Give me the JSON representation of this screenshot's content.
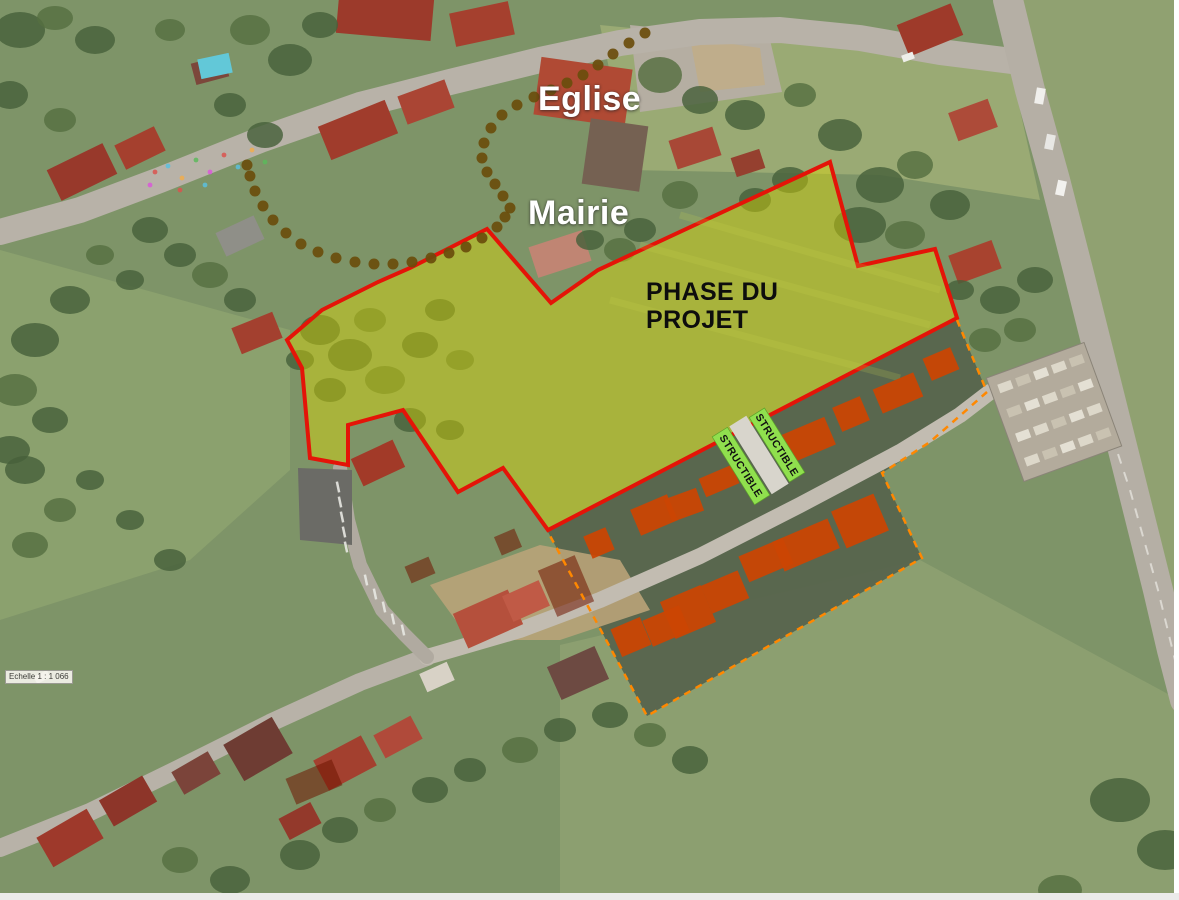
{
  "labels": {
    "eglise": "Eglise",
    "mairie": "Mairie",
    "phase_line1": "PHASE DU",
    "phase_line2": "PROJET",
    "band1": "STRUCTIBLE",
    "band2": "STRUCTIBLE",
    "scale": "Echelle 1 : 1 066"
  },
  "colors": {
    "project_outline": "#e41408",
    "project_fill": "rgba(226,222,0,0.42)",
    "footprint": "#cb4503",
    "demolition": "#6f1400",
    "parcel_dash": "#ff8800",
    "band_green": "#90e04e",
    "trail_dot": "#6a4d0c",
    "road_gray": "#b8b2a8",
    "tree_green": "#47603a",
    "dark_band": "#57644d"
  },
  "map": {
    "base": "#7e9468",
    "fields": [
      {
        "points": "600,25 1010,65 1040,200 880,175 630,170",
        "fill": "#9aaa74"
      },
      {
        "points": "1012,0 1179,0 1179,680",
        "fill": "#90a171"
      },
      {
        "points": "560,645 920,560 1179,700 1179,893 560,893",
        "fill": "#8c9f70"
      },
      {
        "points": "0,250 290,330 290,470 190,560 0,620",
        "fill": "#8ba16e"
      },
      {
        "points": "630,25 770,40 782,92 640,112",
        "fill": "#b5aea2"
      }
    ],
    "dark_band": {
      "points": "548,532 957,320 987,392 930,442 882,473 922,558 647,716",
      "fill": "#57644d"
    },
    "tan_patches": [
      {
        "points": "430,585 540,545 620,560 650,610 560,640 470,640",
        "fill": "#b9a379"
      },
      {
        "points": "690,38 760,48 765,85 700,92",
        "fill": "#c0ad88"
      }
    ],
    "roads": [
      {
        "pts": [
          [
            0,
            232
          ],
          [
            80,
            210
          ],
          [
            160,
            180
          ],
          [
            260,
            140
          ],
          [
            360,
            105
          ],
          [
            450,
            82
          ],
          [
            540,
            60
          ],
          [
            620,
            43
          ],
          [
            700,
            32
          ],
          [
            780,
            30
          ],
          [
            860,
            38
          ],
          [
            940,
            52
          ],
          [
            1020,
            62
          ]
        ],
        "w": 26,
        "c": "#b8b2a8"
      },
      {
        "pts": [
          [
            1008,
            0
          ],
          [
            1030,
            90
          ],
          [
            1055,
            180
          ],
          [
            1078,
            270
          ],
          [
            1098,
            350
          ],
          [
            1118,
            430
          ],
          [
            1138,
            510
          ],
          [
            1158,
            590
          ],
          [
            1172,
            650
          ],
          [
            1185,
            700
          ]
        ],
        "w": 30,
        "c": "#b5afa5"
      },
      {
        "pts": [
          [
            0,
            848
          ],
          [
            90,
            812
          ],
          [
            180,
            768
          ],
          [
            270,
            723
          ],
          [
            360,
            682
          ],
          [
            427,
            657
          ]
        ],
        "w": 18,
        "c": "#b8b2a8"
      },
      {
        "pts": [
          [
            427,
            657
          ],
          [
            520,
            630
          ],
          [
            600,
            600
          ],
          [
            700,
            556
          ],
          [
            800,
            505
          ],
          [
            900,
            452
          ],
          [
            960,
            415
          ],
          [
            990,
            392
          ]
        ],
        "w": 16,
        "c": "#c2bcb1"
      },
      {
        "pts": [
          [
            340,
            468
          ],
          [
            348,
            520
          ],
          [
            360,
            565
          ],
          [
            382,
            610
          ],
          [
            404,
            634
          ],
          [
            427,
            657
          ]
        ],
        "w": 14,
        "c": "#b0aaa0"
      }
    ],
    "road_centerline": {
      "pts": [
        [
          1100,
          400
        ],
        [
          1130,
          490
        ],
        [
          1158,
          590
        ],
        [
          1175,
          660
        ]
      ],
      "c": "#e8e6e0"
    },
    "parking": {
      "points": "298,468 352,470 352,545 300,540",
      "fill": "#6b6b66"
    },
    "parking_ticks": [
      [
        338,
        487
      ],
      [
        340,
        502
      ],
      [
        342,
        517
      ],
      [
        344,
        532
      ],
      [
        346,
        547
      ],
      [
        366,
        580
      ],
      [
        375,
        594
      ],
      [
        384,
        607
      ],
      [
        393,
        619
      ],
      [
        403,
        630
      ]
    ],
    "cemetery": {
      "x": 1002,
      "y": 357,
      "w": 104,
      "h": 110,
      "rot": -20,
      "rows": 4,
      "cols": 5,
      "base": "#b3ab9c"
    },
    "houses": [
      [
        385,
        16,
        95,
        42,
        5,
        "#9c3a2b"
      ],
      [
        482,
        24,
        60,
        34,
        -12,
        "#a5402e"
      ],
      [
        583,
        92,
        92,
        58,
        8,
        "#b04a34"
      ],
      [
        615,
        155,
        58,
        66,
        8,
        "#756152"
      ],
      [
        695,
        148,
        46,
        30,
        -18,
        "#a84836"
      ],
      [
        748,
        163,
        30,
        20,
        -18,
        "#95402f"
      ],
      [
        930,
        30,
        58,
        34,
        -22,
        "#9e3a2a"
      ],
      [
        973,
        120,
        42,
        30,
        -20,
        "#ad4b39"
      ],
      [
        82,
        172,
        62,
        34,
        -26,
        "#98392b"
      ],
      [
        140,
        148,
        44,
        27,
        -26,
        "#a5402e"
      ],
      [
        210,
        70,
        34,
        22,
        -15,
        "#7c473b"
      ],
      [
        215,
        66,
        32,
        20,
        -12,
        "#62c8d8"
      ],
      [
        358,
        130,
        72,
        36,
        -22,
        "#a03c2c"
      ],
      [
        426,
        102,
        50,
        30,
        -20,
        "#aa4534"
      ],
      [
        240,
        236,
        42,
        26,
        -25,
        "#8f8f88"
      ],
      [
        257,
        333,
        44,
        28,
        -22,
        "#a3402f"
      ],
      [
        560,
        254,
        56,
        32,
        -18,
        "#c08573"
      ],
      [
        378,
        463,
        46,
        30,
        -25,
        "#a23a28"
      ],
      [
        975,
        262,
        46,
        30,
        -20,
        "#a8432f"
      ],
      [
        70,
        838,
        58,
        34,
        -30,
        "#9e392b"
      ],
      [
        128,
        801,
        50,
        30,
        -30,
        "#8d3529"
      ],
      [
        196,
        773,
        42,
        26,
        -30,
        "#7b443a"
      ],
      [
        258,
        749,
        56,
        42,
        -30,
        "#6e3c33"
      ],
      [
        345,
        763,
        54,
        34,
        -28,
        "#a3402f"
      ],
      [
        398,
        737,
        42,
        26,
        -28,
        "#b04a3a"
      ],
      [
        300,
        821,
        36,
        24,
        -28,
        "#93392b"
      ],
      [
        488,
        619,
        60,
        38,
        -24,
        "#b5503c"
      ],
      [
        526,
        601,
        40,
        28,
        -24,
        "#c05a46"
      ],
      [
        578,
        673,
        52,
        36,
        -24,
        "#6d4a42"
      ],
      [
        437,
        677,
        30,
        20,
        -24,
        "#d8d2c6"
      ]
    ],
    "trees": [
      [
        660,
        75,
        22,
        18
      ],
      [
        700,
        100,
        18,
        14
      ],
      [
        745,
        115,
        20,
        15
      ],
      [
        800,
        95,
        16,
        12
      ],
      [
        840,
        135,
        22,
        16
      ],
      [
        880,
        185,
        24,
        18
      ],
      [
        915,
        165,
        18,
        14
      ],
      [
        950,
        205,
        20,
        15
      ],
      [
        860,
        225,
        26,
        18
      ],
      [
        905,
        235,
        20,
        14
      ],
      [
        790,
        180,
        18,
        13
      ],
      [
        755,
        200,
        16,
        12
      ],
      [
        680,
        195,
        18,
        14
      ],
      [
        640,
        230,
        16,
        12
      ],
      [
        20,
        30,
        25,
        18
      ],
      [
        55,
        18,
        18,
        12
      ],
      [
        95,
        40,
        20,
        14
      ],
      [
        10,
        95,
        18,
        14
      ],
      [
        250,
        30,
        20,
        15
      ],
      [
        290,
        60,
        22,
        16
      ],
      [
        320,
        25,
        18,
        13
      ],
      [
        170,
        30,
        15,
        11
      ],
      [
        230,
        105,
        16,
        12
      ],
      [
        265,
        135,
        18,
        13
      ],
      [
        60,
        120,
        16,
        12
      ],
      [
        150,
        230,
        18,
        13
      ],
      [
        180,
        255,
        16,
        12
      ],
      [
        210,
        275,
        18,
        13
      ],
      [
        240,
        300,
        16,
        12
      ],
      [
        130,
        280,
        14,
        10
      ],
      [
        100,
        255,
        14,
        10
      ],
      [
        70,
        300,
        20,
        14
      ],
      [
        35,
        340,
        24,
        17
      ],
      [
        15,
        390,
        22,
        16
      ],
      [
        50,
        420,
        18,
        13
      ],
      [
        25,
        470,
        20,
        14
      ],
      [
        60,
        510,
        16,
        12
      ],
      [
        90,
        480,
        14,
        10
      ],
      [
        10,
        450,
        20,
        14
      ],
      [
        30,
        545,
        18,
        13
      ],
      [
        320,
        330,
        20,
        15
      ],
      [
        350,
        355,
        22,
        16
      ],
      [
        385,
        380,
        20,
        14
      ],
      [
        420,
        345,
        18,
        13
      ],
      [
        330,
        390,
        16,
        12
      ],
      [
        370,
        320,
        16,
        12
      ],
      [
        300,
        360,
        14,
        10
      ],
      [
        440,
        310,
        15,
        11
      ],
      [
        460,
        360,
        14,
        10
      ],
      [
        410,
        420,
        16,
        12
      ],
      [
        450,
        430,
        14,
        10
      ],
      [
        620,
        250,
        16,
        12
      ],
      [
        590,
        240,
        14,
        10
      ],
      [
        1000,
        300,
        20,
        14
      ],
      [
        1020,
        330,
        16,
        12
      ],
      [
        960,
        290,
        14,
        10
      ],
      [
        1035,
        280,
        18,
        13
      ],
      [
        985,
        340,
        16,
        12
      ],
      [
        1120,
        800,
        30,
        22
      ],
      [
        1165,
        850,
        28,
        20
      ],
      [
        1060,
        890,
        22,
        15
      ],
      [
        300,
        855,
        20,
        15
      ],
      [
        340,
        830,
        18,
        13
      ],
      [
        380,
        810,
        16,
        12
      ],
      [
        430,
        790,
        18,
        13
      ],
      [
        470,
        770,
        16,
        12
      ],
      [
        520,
        750,
        18,
        13
      ],
      [
        560,
        730,
        16,
        12
      ],
      [
        610,
        715,
        18,
        13
      ],
      [
        650,
        735,
        16,
        12
      ],
      [
        690,
        760,
        18,
        14
      ],
      [
        230,
        880,
        20,
        14
      ],
      [
        180,
        860,
        18,
        13
      ],
      [
        130,
        520,
        14,
        10
      ],
      [
        170,
        560,
        16,
        11
      ]
    ],
    "chalk_dots": {
      "pts": [
        [
          155,
          172
        ],
        [
          168,
          166
        ],
        [
          182,
          178
        ],
        [
          196,
          160
        ],
        [
          210,
          172
        ],
        [
          224,
          155
        ],
        [
          238,
          167
        ],
        [
          252,
          150
        ],
        [
          265,
          162
        ],
        [
          150,
          185
        ],
        [
          180,
          190
        ],
        [
          205,
          185
        ]
      ],
      "cols": [
        "#d9534f",
        "#5bc0de",
        "#f0ad4e",
        "#5cb85c",
        "#d957d9"
      ]
    },
    "project_polygon": {
      "points": "830,162 858,266 935,249 957,318 548,530 503,468 458,492 403,410 348,425 348,465 310,458 302,368 287,340 322,310 378,282 410,268 487,229 551,303 598,270"
    },
    "mow_lines": [
      "640,245 930,325",
      "610,300 900,378",
      "680,215 940,290"
    ],
    "footprints": [
      [
        808,
        440,
        48,
        30,
        -23
      ],
      [
        851,
        414,
        30,
        26,
        -23
      ],
      [
        898,
        393,
        44,
        26,
        -23
      ],
      [
        941,
        364,
        30,
        24,
        -23
      ],
      [
        599,
        543,
        24,
        24,
        -23
      ],
      [
        654,
        515,
        40,
        28,
        -23
      ],
      [
        684,
        505,
        34,
        24,
        -20
      ],
      [
        719,
        481,
        36,
        20,
        -23
      ],
      [
        688,
        612,
        44,
        40,
        -23
      ],
      [
        725,
        592,
        40,
        30,
        -23
      ],
      [
        766,
        560,
        48,
        28,
        -23
      ],
      [
        806,
        545,
        60,
        32,
        -23
      ],
      [
        860,
        521,
        46,
        40,
        -23
      ],
      [
        631,
        637,
        32,
        30,
        -23
      ],
      [
        666,
        626,
        40,
        28,
        -23
      ]
    ],
    "demolition_overlays": [
      [
        508,
        542,
        22,
        20,
        -23
      ],
      [
        566,
        586,
        40,
        50,
        -23
      ],
      [
        420,
        570,
        26,
        18,
        -23
      ],
      [
        314,
        782,
        50,
        28,
        -23
      ]
    ],
    "bands": {
      "path_rect": {
        "cx": 759,
        "cy": 455,
        "w": 20,
        "h": 80
      },
      "items": [
        {
          "cx": 777,
          "cy": 445,
          "len": 76
        },
        {
          "cx": 741,
          "cy": 466,
          "len": 80
        }
      ],
      "rect_rot": -32,
      "text_rot": 58,
      "w": 18
    },
    "parcel_dashed": {
      "points": "957,320 987,392 930,442 882,473 922,558 647,716 548,532"
    },
    "trail_dots": [
      [
        645,
        33
      ],
      [
        629,
        43
      ],
      [
        613,
        54
      ],
      [
        598,
        65
      ],
      [
        583,
        75
      ],
      [
        567,
        83
      ],
      [
        551,
        90
      ],
      [
        534,
        97
      ],
      [
        517,
        105
      ],
      [
        502,
        115
      ],
      [
        491,
        128
      ],
      [
        484,
        143
      ],
      [
        482,
        158
      ],
      [
        487,
        172
      ],
      [
        495,
        184
      ],
      [
        503,
        196
      ],
      [
        510,
        208
      ],
      [
        505,
        217
      ],
      [
        497,
        227
      ],
      [
        482,
        238
      ],
      [
        466,
        247
      ],
      [
        449,
        253
      ],
      [
        431,
        258
      ],
      [
        412,
        262
      ],
      [
        393,
        264
      ],
      [
        374,
        264
      ],
      [
        355,
        262
      ],
      [
        336,
        258
      ],
      [
        318,
        252
      ],
      [
        301,
        244
      ],
      [
        286,
        233
      ],
      [
        273,
        220
      ],
      [
        263,
        206
      ],
      [
        255,
        191
      ],
      [
        250,
        176
      ],
      [
        247,
        165
      ]
    ],
    "vehicles": [
      [
        42,
        677,
        15,
        8,
        -28,
        "#f5f5f2"
      ],
      [
        1040,
        96,
        9,
        16,
        10,
        "#f0efec"
      ],
      [
        1050,
        142,
        9,
        15,
        11,
        "#e8e7e4"
      ],
      [
        1061,
        188,
        9,
        15,
        12,
        "#f2f1ee"
      ],
      [
        908,
        57,
        12,
        7,
        -20,
        "#eeeeea"
      ]
    ],
    "edge_strips": {
      "right": "#ffffff",
      "bottom": "#ebebe9"
    }
  }
}
